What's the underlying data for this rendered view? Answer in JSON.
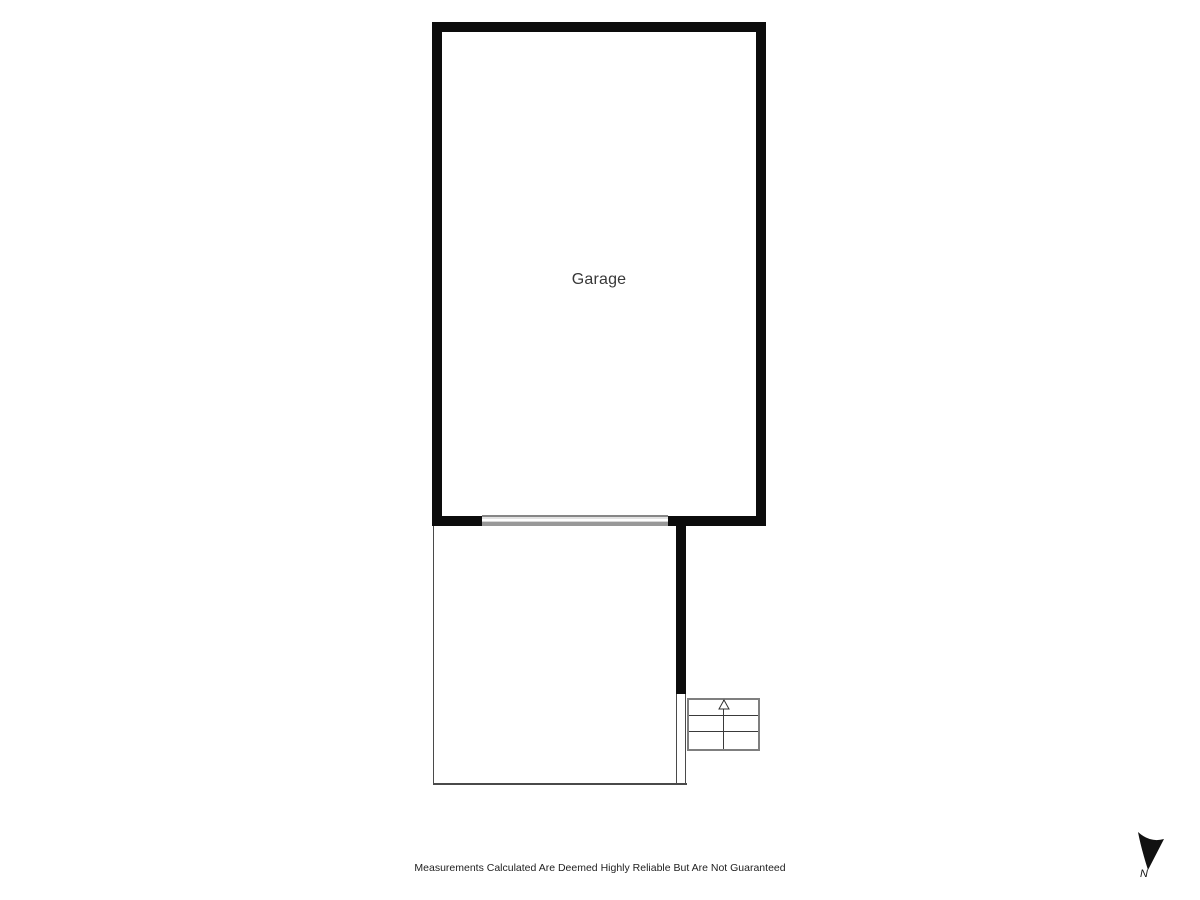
{
  "rooms": {
    "garage": {
      "label": "Garage"
    }
  },
  "footer": {
    "disclaimer": "Measurements Calculated Are Deemed Highly Reliable But Are Not Guaranteed"
  },
  "compass": {
    "north_label": "N"
  },
  "icons": {
    "north_arrow": "north-arrow-icon",
    "stairs_up_arrow": "stairs-up-arrow-icon"
  },
  "colors": {
    "wall": "#0c0c0c",
    "thin_wall": "#4a4a4a",
    "stair_border": "#7f7f7f",
    "stair_line": "#3a3a3a",
    "door_line": "#868686",
    "door_fill": "#e2e2e2",
    "label_text": "#383838",
    "disclaimer_text": "#1f1f1f",
    "background": "#ffffff"
  }
}
